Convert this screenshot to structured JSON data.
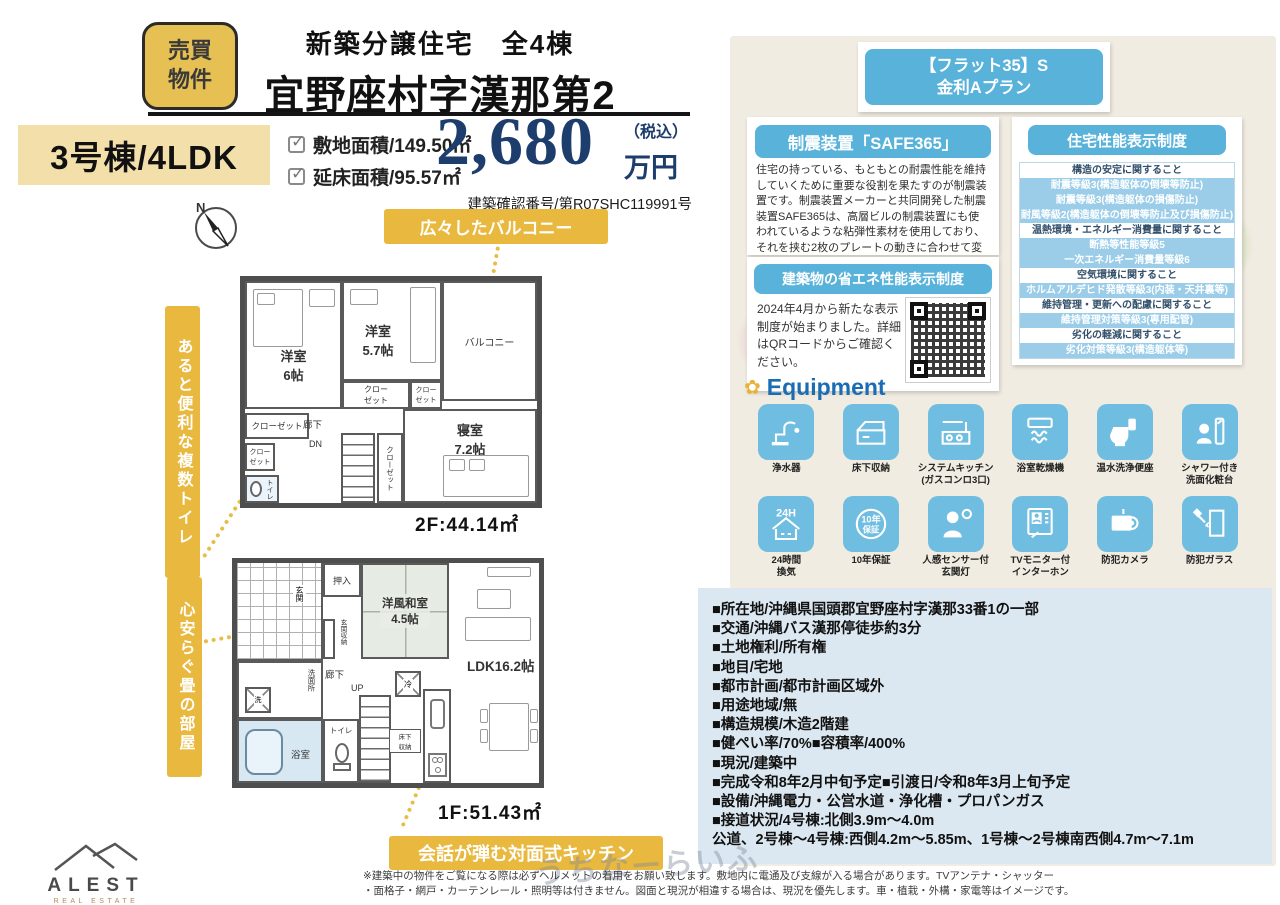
{
  "header": {
    "badge_line1": "売買",
    "badge_line2": "物件",
    "subtitle": "新築分譲住宅　全4棟",
    "title": "宜野座村字漢那第2"
  },
  "summary": {
    "unit": "3号棟/4LDK",
    "land_label": "敷地面積/149.50㎡",
    "floor_label": "延床面積/95.57㎡",
    "price_number": "2,680",
    "tax_note": "（税込）",
    "price_unit": "万円",
    "confirmation_number": "建築確認番号/第R07SHC119991号"
  },
  "flat35": {
    "line1": "【フラット35】S",
    "line2": "金利Aプラン"
  },
  "safe365": {
    "title": "制震装置「SAFE365」",
    "body": "住宅の持っている、もともとの耐震性能を維持していくために重要な役割を果たすのが制震装置です。制震装置メーカーと共同開発した制震装置SAFE365は、高層ビルの制震装置にも使われているような粘弾性素材を使用しており、それを挟む2枚のプレートの動きに合わせて変形し地震の揺れを吸収します。"
  },
  "performance": {
    "title": "住宅性能表示制度",
    "rows": [
      {
        "text": "構造の安定に関すること"
      },
      {
        "text": "耐震等級3(構造躯体の倒壊等防止)"
      },
      {
        "text": "耐震等級3(構造躯体の損傷防止)"
      },
      {
        "text": "耐風等級2(構造躯体の倒壊等防止及び損傷防止)"
      },
      {
        "text": "温熱環境・エネルギー消費量に関すること"
      },
      {
        "text": "断熱等性能等級5"
      },
      {
        "text": "一次エネルギー消費量等級6"
      },
      {
        "text": "空気環境に関すること"
      },
      {
        "text": "ホルムアルデヒド発散等級3(内装・天井裏等)"
      },
      {
        "text": "維持管理・更新への配慮に関すること"
      },
      {
        "text": "維持管理対策等級3(専用配管)"
      },
      {
        "text": "劣化の軽減に関すること"
      },
      {
        "text": "劣化対策等級3(構造躯体等)"
      }
    ]
  },
  "energy": {
    "title": "建築物の省エネ性能表示制度",
    "body": "2024年4月から新たな表示制度が始まりました。詳細はQRコードからご確認ください。"
  },
  "equipment": {
    "title": "Equipment",
    "items": [
      {
        "label": "浄水器"
      },
      {
        "label": "床下収納"
      },
      {
        "label": "システムキッチン\n(ガスコンロ3口)"
      },
      {
        "label": "浴室乾燥機"
      },
      {
        "label": "温水洗浄便座"
      },
      {
        "label": "シャワー付き\n洗面化粧台"
      },
      {
        "label": "24時間\n換気"
      },
      {
        "label": "10年保証"
      },
      {
        "label": "人感センサー付\n玄関灯"
      },
      {
        "label": "TVモニター付\nインターホン"
      },
      {
        "label": "防犯カメラ"
      },
      {
        "label": "防犯ガラス"
      }
    ]
  },
  "details": {
    "lines": [
      "■所在地/沖縄県国頭郡宜野座村字漢那33番1の一部",
      "■交通/沖縄バス漢那停徒歩約3分",
      "■土地権利/所有権",
      "■地目/宅地",
      "■都市計画/都市計画区域外",
      "■用途地域/無",
      "■構造規模/木造2階建",
      "■健ぺい率/70%■容積率/400%",
      "■現況/建築中",
      "■完成令和8年2月中旬予定■引渡日/令和8年3月上旬予定",
      "■設備/沖縄電力・公営水道・浄化槽・プロパンガス",
      "■接道状況/4号棟:北側3.9m〜4.0m",
      "公道、2号棟〜4号棟:西側4.2m〜5.85m、1号棟〜2号棟南西側4.7m〜7.1m"
    ]
  },
  "plan2f": {
    "area": "2F:44.14㎡",
    "callout_balcony": "広々したバルコニー",
    "callout_toilet": "あると便利な複数トイレ",
    "rooms": {
      "yoshitsu6": "洋室\n6帖",
      "yoshitsu57": "洋室\n5.7帖",
      "balcony": "バルコニー",
      "closet2": "クロー\nゼット",
      "closet": "クローゼット",
      "bedroom": "寝室\n7.2帖",
      "hall": "廊下",
      "dn": "DN",
      "toilet": "トイレ"
    }
  },
  "plan1f": {
    "area": "1F:51.43㎡",
    "callout_kitchen": "会話が弾む対面式キッチン",
    "callout_tatami": "心安らぐ畳の部屋",
    "rooms": {
      "oshiire": "押入",
      "genkan": "玄関",
      "genkan_storage": "玄関収納",
      "washitsu": "洋風和室\n4.5帖",
      "hall": "廊下",
      "up": "UP",
      "senmenjo": "洗面所",
      "washer": "洗",
      "bath": "浴室",
      "toilet": "トイレ",
      "fridge": "冷",
      "yukashita": "床下\n収納",
      "ldk": "LDK16.2帖"
    }
  },
  "compass": {
    "label": "N"
  },
  "logo": {
    "name": "ALEST",
    "sub": "REAL ESTATE"
  },
  "watermark": "うちなーらいふ",
  "footer": {
    "line1": "※建築中の物件をご覧になる際は必ずヘルメットの着用をお願い致します。敷地内に電通及び支線が入る場合があります。TVアンテナ・シャッター",
    "line2": "・面格子・網戸・カーテンレール・照明等は付きません。図面と現況が相違する場合は、現況を優先します。車・植栽・外構・家電等はイメージです。"
  }
}
